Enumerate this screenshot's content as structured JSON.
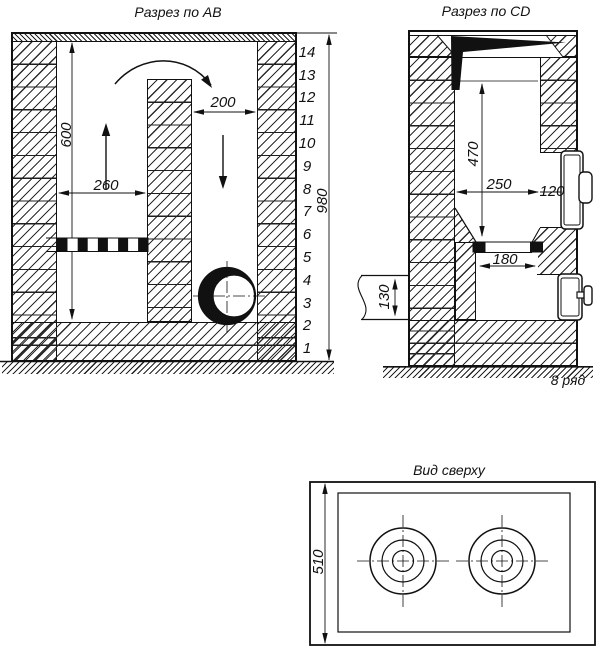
{
  "drawing": {
    "ab": {
      "title": "Разрез по АВ",
      "dim_600": "600",
      "dim_260": "260",
      "dim_200": "200",
      "dim_980": "980",
      "rows": [
        "14",
        "13",
        "12",
        "11",
        "10",
        "9",
        "8",
        "7",
        "6",
        "5",
        "4",
        "3",
        "2",
        "1"
      ]
    },
    "cd": {
      "title": "Разрез по CD",
      "dim_470": "470",
      "dim_250": "250",
      "dim_120": "120",
      "dim_180": "180",
      "dim_130": "130",
      "row_note": "8 ряд"
    },
    "top": {
      "title": "Вид сверху",
      "dim_510": "510"
    },
    "colors": {
      "line": "#111111",
      "fill_black": "#111111",
      "background": "#ffffff"
    }
  }
}
